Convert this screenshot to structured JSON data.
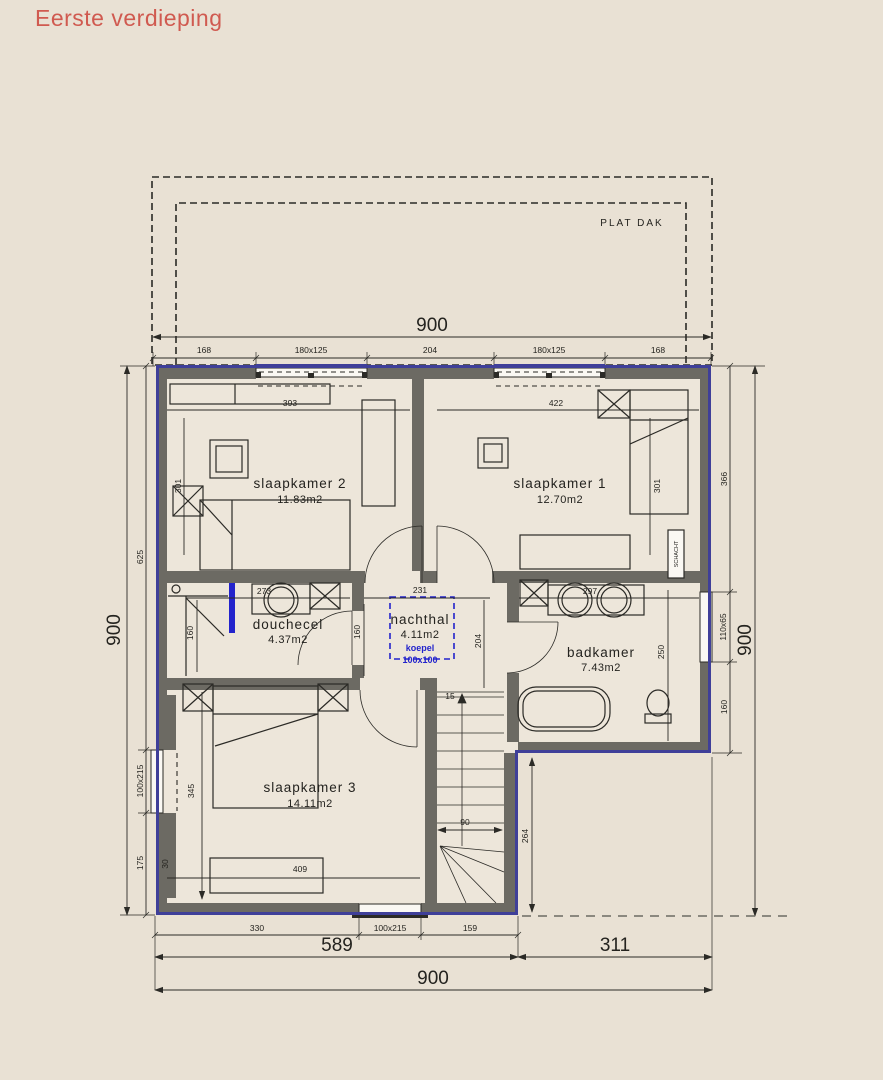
{
  "title": "Eerste verdieping",
  "roof": {
    "label": "PLAT DAK",
    "overall": "900",
    "segments": [
      "168",
      "180x125",
      "204",
      "180x125",
      "168"
    ]
  },
  "rooms": {
    "slaapkamer2": {
      "name": "slaapkamer 2",
      "area": "11.83m2",
      "width": "393",
      "depth": "301"
    },
    "slaapkamer1": {
      "name": "slaapkamer 1",
      "area": "12.70m2",
      "width": "422",
      "depth": "301"
    },
    "douchecel": {
      "name": "douchecel",
      "area": "4.37m2",
      "width": "273",
      "shower_height": "160"
    },
    "nachthal": {
      "name": "nachthal",
      "area": "4.11m2",
      "width": "231",
      "left": "160",
      "right": "204",
      "koepel": "koepel",
      "koepel_size": "100x100"
    },
    "badkamer": {
      "name": "badkamer",
      "area": "7.43m2",
      "width": "297",
      "depth": "250"
    },
    "slaapkamer3": {
      "name": "slaapkamer 3",
      "area": "14.11m2",
      "width": "409",
      "depth": "345"
    }
  },
  "stairs": {
    "first_step": "15",
    "width": "90"
  },
  "labels": {
    "shaft": "SCHACHT",
    "wall_note": "30"
  },
  "dims": {
    "left": {
      "overall": "900",
      "segments": [
        "625",
        "100x215",
        "175"
      ]
    },
    "right": {
      "overall": "900",
      "segments": [
        "366",
        "110x65",
        "160"
      ]
    },
    "bottom": {
      "overall": "900",
      "left": "589",
      "right": "311",
      "segments": [
        "330",
        "100x215",
        "159"
      ]
    },
    "notch": "264"
  },
  "colors": {
    "background": "#e9e1d4",
    "wall_gray": "#6c6a63",
    "outline_blue": "#3f3f99",
    "koepel_blue": "#2323cc",
    "title_red": "#d05a50"
  }
}
